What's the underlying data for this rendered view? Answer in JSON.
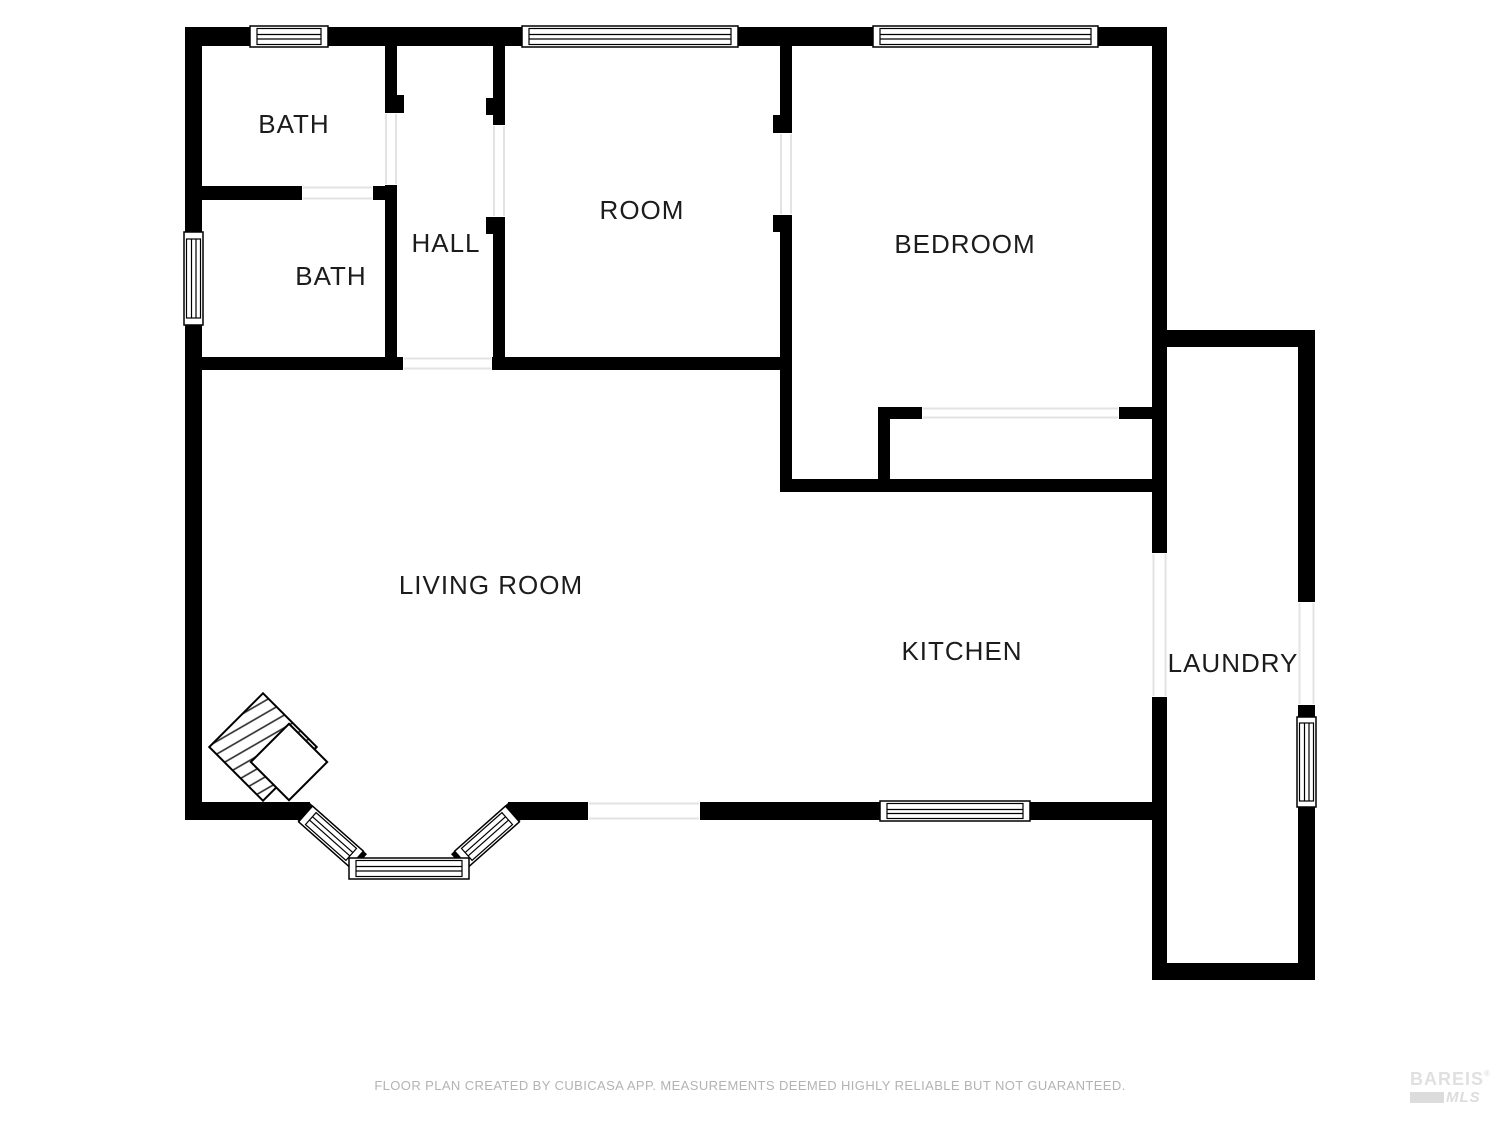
{
  "page": {
    "background": "#ffffff",
    "wall_color": "#000000",
    "label_color": "#1c1c1c",
    "threshold_color": "#e3e3e3"
  },
  "floor_plan": {
    "rooms": [
      {
        "name": "BATH"
      },
      {
        "name": "BATH"
      },
      {
        "name": "HALL"
      },
      {
        "name": "ROOM"
      },
      {
        "name": "BEDROOM"
      },
      {
        "name": "LIVING ROOM"
      },
      {
        "name": "KITCHEN"
      },
      {
        "name": "LAUNDRY"
      }
    ]
  },
  "footer": {
    "disclaimer": "FLOOR PLAN CREATED BY CUBICASA APP. MEASUREMENTS DEEMED HIGHLY RELIABLE BUT NOT GUARANTEED."
  },
  "watermark": {
    "brand": "BAREIS",
    "registered_mark": "®",
    "suffix": "MLS"
  }
}
